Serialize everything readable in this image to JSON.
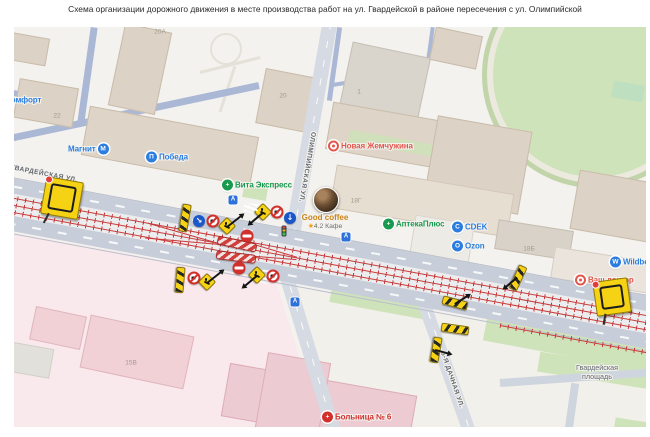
{
  "title": "Схема организации дорожного движения в месте производства работ на ул. Гвардейской в районе пересечения с ул. Олимпийской",
  "colors": {
    "poi_blue": "#2b7de0",
    "poi_green": "#199a4e",
    "poi_red": "#e2574c",
    "sign_yellow": "#f6d215",
    "sign_red": "#d2302c",
    "sign_blue": "#1a57c8",
    "tram_red": "#c93a3a",
    "hospital_red": "#d2302c"
  },
  "map": {
    "street_labels": [
      {
        "text": "ГВАРДЕЙСКАЯ УЛ.",
        "x": 30,
        "y": 147,
        "rot": 11,
        "wrap": 0
      },
      {
        "text": "ОЛИМПИЙСКАЯ УЛ.",
        "x": 293,
        "y": 140,
        "rot": 100,
        "wrap": 0
      },
      {
        "text": "5-Я ДАЧНАЯ УЛ.",
        "x": 438,
        "y": 353,
        "rot": 71,
        "wrap": 0
      },
      {
        "text": "Гвардейская площадь",
        "x": 583,
        "y": 345,
        "rot": 0,
        "wrap": 58
      }
    ],
    "house_numbers": [
      {
        "text": "20А",
        "x": 146,
        "y": 5
      },
      {
        "text": "22",
        "x": 43,
        "y": 89
      },
      {
        "text": "20",
        "x": 269,
        "y": 69
      },
      {
        "text": "1",
        "x": 345,
        "y": 65
      },
      {
        "text": "18Г",
        "x": 342,
        "y": 174
      },
      {
        "text": "18Б",
        "x": 515,
        "y": 222
      },
      {
        "text": "15В",
        "x": 117,
        "y": 336
      }
    ],
    "pois": [
      {
        "name": "Комфорт",
        "x": -8,
        "y": 73,
        "color": "#2b7de0",
        "icon": "none",
        "glyph": ""
      },
      {
        "name": "Магнит",
        "x": 54,
        "y": 122,
        "color": "#2b7de0",
        "icon": "circle",
        "glyph": "М",
        "icon_side": "right"
      },
      {
        "name": "Победа",
        "x": 132,
        "y": 130,
        "color": "#2b7de0",
        "icon": "circle",
        "glyph": "П"
      },
      {
        "name": "Вита Экспресс",
        "x": 208,
        "y": 158,
        "color": "#199a4e",
        "icon": "cross",
        "glyph": "+"
      },
      {
        "name": "Новая Жемчужина",
        "x": 314,
        "y": 119,
        "color": "#e2574c",
        "icon": "ring",
        "glyph": ""
      },
      {
        "name": "АптекаПлюс",
        "x": 369,
        "y": 197,
        "color": "#199a4e",
        "icon": "cross",
        "glyph": "+"
      },
      {
        "name": "CDEK",
        "x": 438,
        "y": 200,
        "color": "#2b7de0",
        "icon": "circle",
        "glyph": "C"
      },
      {
        "name": "Ozon",
        "x": 438,
        "y": 219,
        "color": "#2b7de0",
        "icon": "circle",
        "glyph": "O"
      },
      {
        "name": "Wildberries",
        "x": 596,
        "y": 235,
        "color": "#2b7de0",
        "icon": "circle",
        "glyph": "W"
      },
      {
        "name": "Ваш доктор",
        "x": 561,
        "y": 253,
        "color": "#e2574c",
        "icon": "ring",
        "glyph": ""
      },
      {
        "name": "Больница № 6",
        "x": 308,
        "y": 390,
        "color": "#d2302c",
        "icon": "redcross",
        "glyph": "+"
      }
    ],
    "featured_poi": {
      "name": "Good coffee",
      "rating": "4.2",
      "category": "Кафе",
      "star": "★",
      "x": 311,
      "y": 172
    },
    "signs": [
      {
        "type": "scheme",
        "x": 48,
        "y": 171,
        "s": 36,
        "rot": 10
      },
      {
        "type": "scheme",
        "x": 598,
        "y": 270,
        "s": 33,
        "rot": -8
      },
      {
        "type": "board",
        "x": 171,
        "y": 191,
        "rot": 100,
        "w": 26,
        "h": 7
      },
      {
        "type": "blue",
        "x": 185,
        "y": 194,
        "glyph": "↘"
      },
      {
        "type": "prohibit",
        "x": 199,
        "y": 194
      },
      {
        "type": "diamond",
        "x": 213,
        "y": 199,
        "arrow": {
          "angle": -38,
          "len": 18
        }
      },
      {
        "type": "diamond",
        "x": 249,
        "y": 185,
        "arrow": {
          "angle": 140,
          "len": 16
        }
      },
      {
        "type": "prohibit",
        "x": 263,
        "y": 185
      },
      {
        "type": "blue",
        "x": 276,
        "y": 191,
        "glyph": "↓"
      },
      {
        "type": "transit",
        "x": 219,
        "y": 173,
        "glyph": "А"
      },
      {
        "type": "light",
        "x": 270,
        "y": 204
      },
      {
        "type": "zebra",
        "x": 237,
        "y": 181,
        "rot": 10,
        "w": 14,
        "h": 9
      },
      {
        "type": "zebra",
        "x": 252,
        "y": 252,
        "rot": 12,
        "w": 14,
        "h": 9
      },
      {
        "type": "brick",
        "x": 233,
        "y": 209
      },
      {
        "type": "chain",
        "x": 223,
        "y": 217,
        "rot": 12,
        "w": 38,
        "h": 7
      },
      {
        "type": "chain",
        "x": 222,
        "y": 230,
        "rot": 7,
        "w": 38,
        "h": 7
      },
      {
        "type": "brick",
        "x": 225,
        "y": 241
      },
      {
        "type": "diamond",
        "x": 243,
        "y": 248,
        "arrow": {
          "angle": 140,
          "len": 16
        }
      },
      {
        "type": "prohibit",
        "x": 259,
        "y": 249
      },
      {
        "type": "transit",
        "x": 332,
        "y": 210,
        "glyph": "А"
      },
      {
        "type": "board",
        "x": 166,
        "y": 253,
        "rot": 95,
        "w": 24,
        "h": 7
      },
      {
        "type": "prohibit",
        "x": 180,
        "y": 251
      },
      {
        "type": "diamond",
        "x": 193,
        "y": 255,
        "arrow": {
          "angle": -38,
          "len": 18
        }
      },
      {
        "type": "transit",
        "x": 281,
        "y": 275,
        "glyph": "А"
      },
      {
        "type": "board",
        "x": 504,
        "y": 251,
        "rot": 115,
        "w": 24,
        "h": 7,
        "arrow": {
          "angle": 140,
          "len": 15
        }
      },
      {
        "type": "board",
        "x": 441,
        "y": 276,
        "rot": 15,
        "w": 24,
        "h": 7,
        "arrow": {
          "angle": -32,
          "len": 15
        }
      },
      {
        "type": "board",
        "x": 441,
        "y": 302,
        "rot": 8,
        "w": 26,
        "h": 7
      },
      {
        "type": "board",
        "x": 422,
        "y": 323,
        "rot": 100,
        "w": 24,
        "h": 7,
        "arrow": {
          "angle": 15,
          "len": 14
        }
      }
    ]
  }
}
